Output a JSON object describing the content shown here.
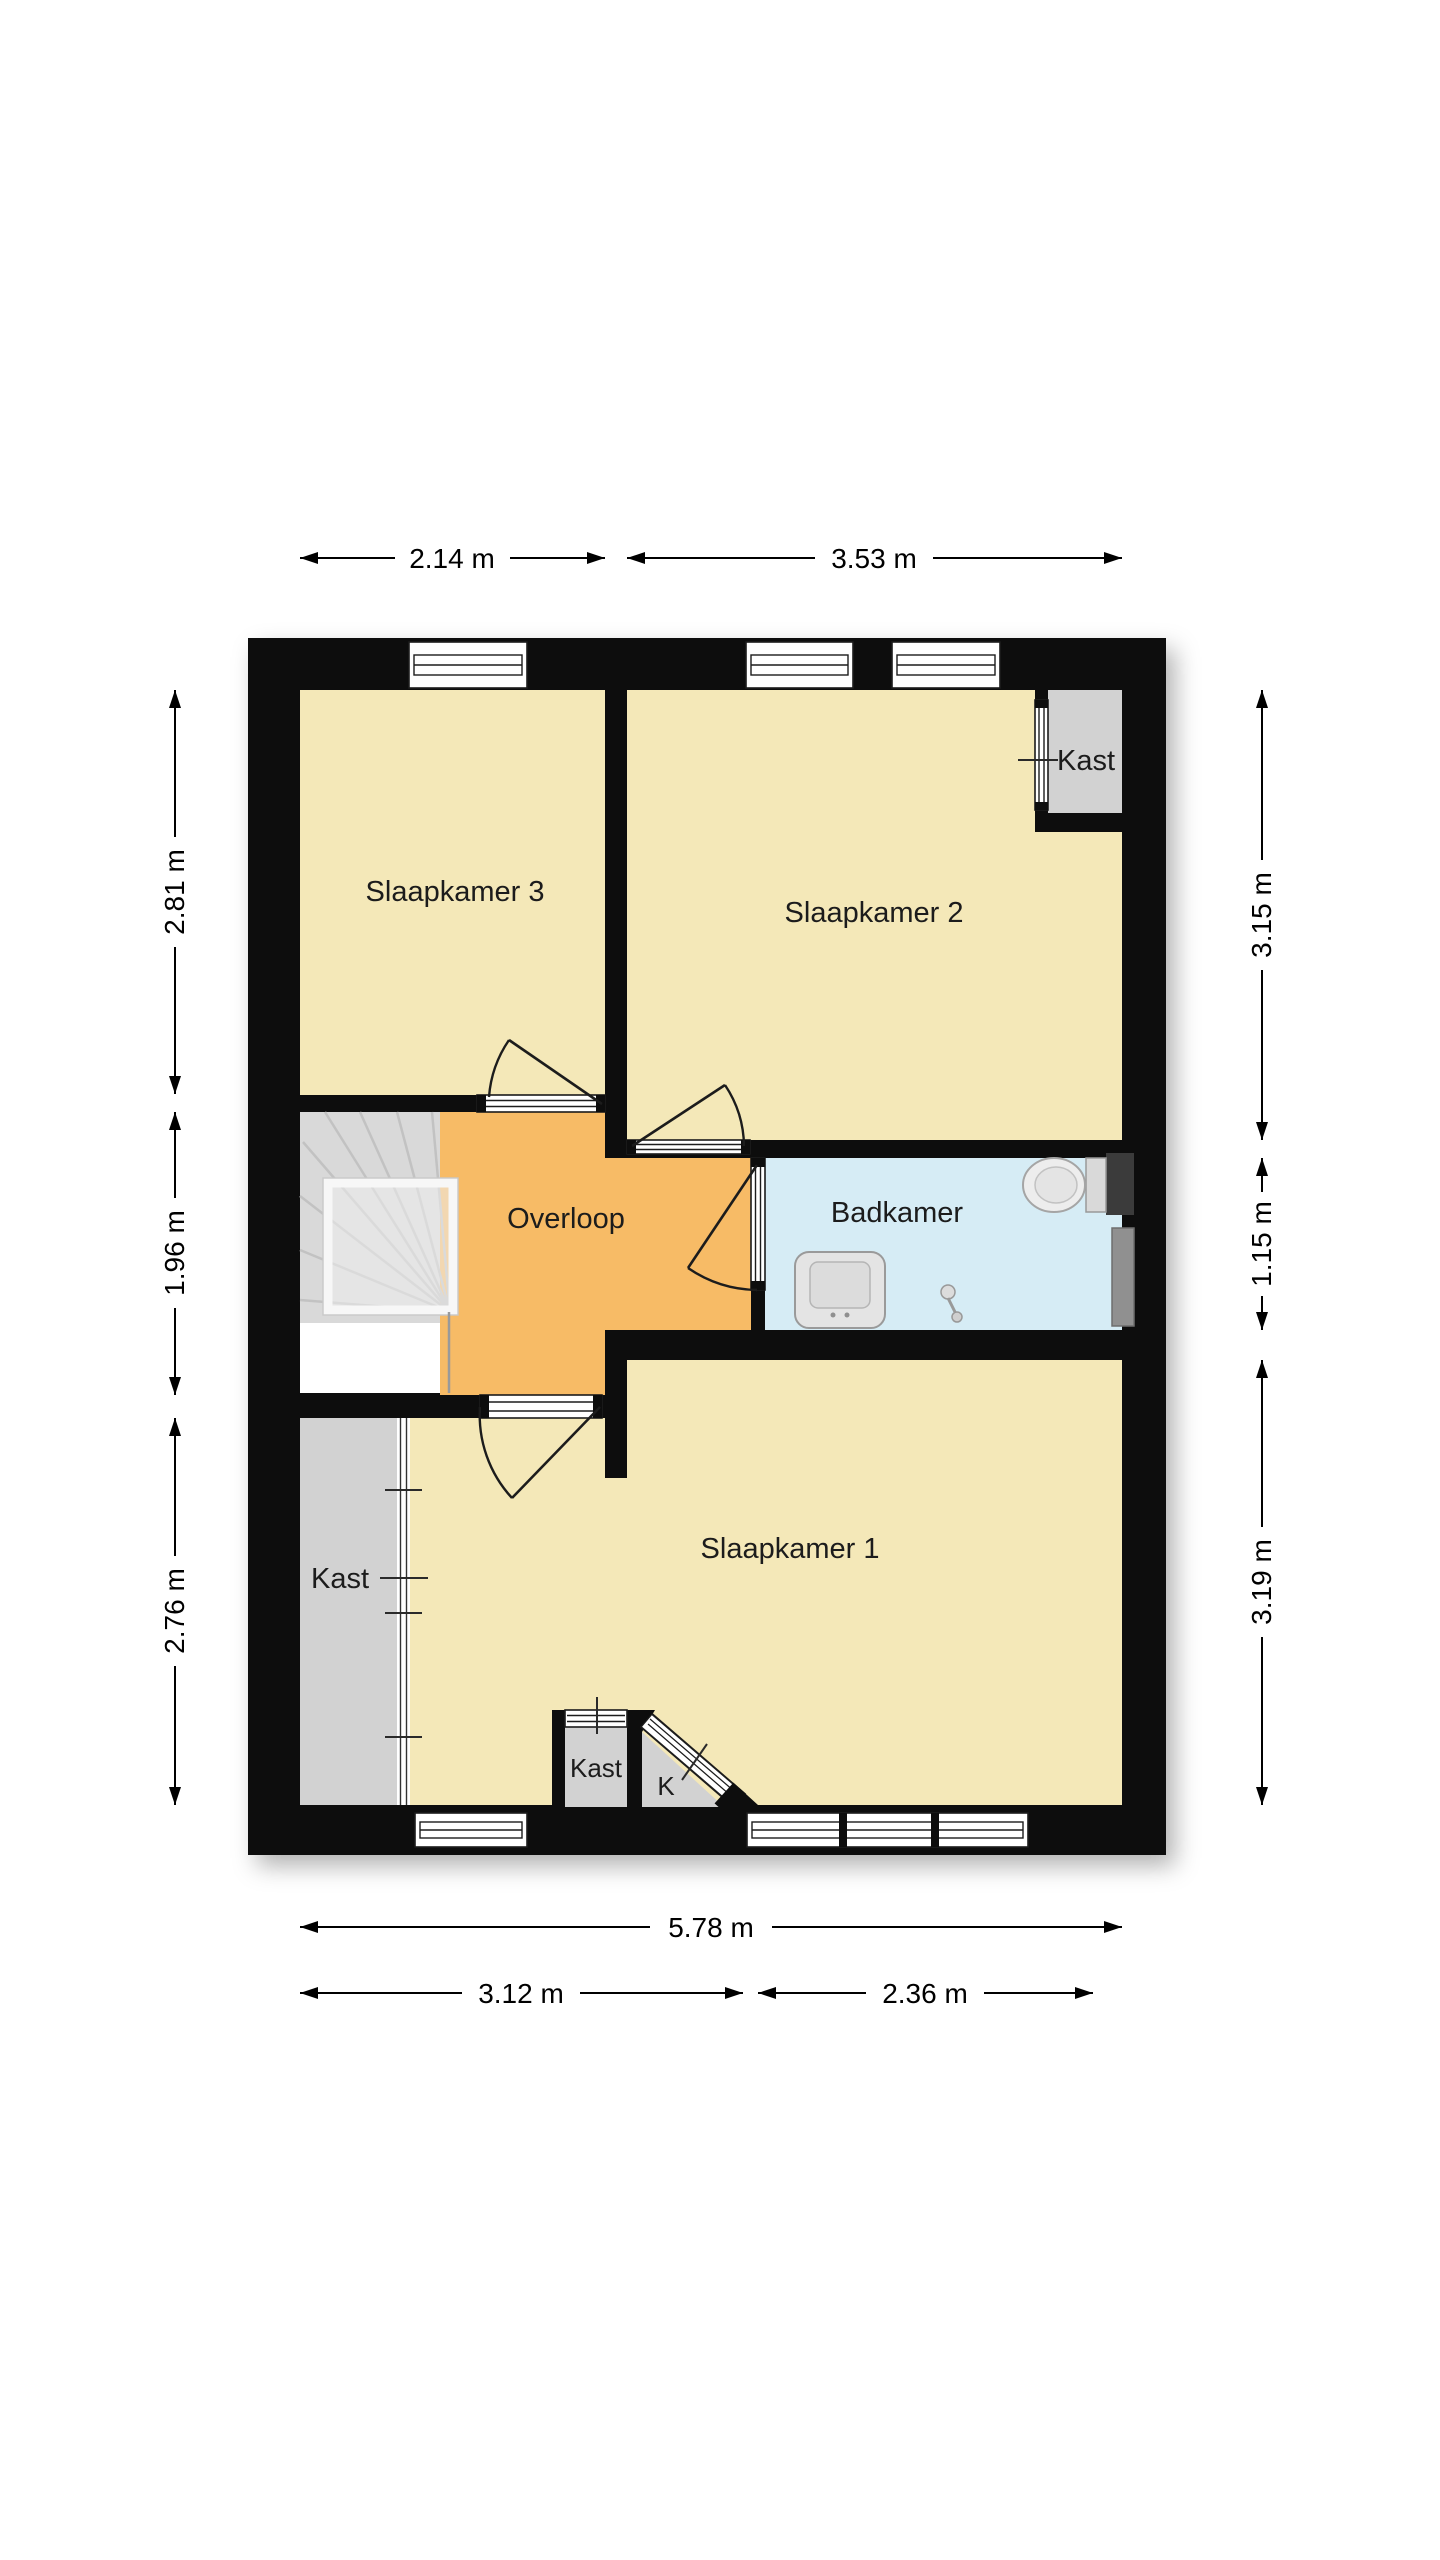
{
  "floorplan": {
    "rooms": {
      "slaapkamer3": "Slaapkamer 3",
      "slaapkamer2": "Slaapkamer 2",
      "slaapkamer1": "Slaapkamer 1",
      "overloop": "Overloop",
      "badkamer": "Badkamer",
      "kast_top_right": "Kast",
      "kast_left": "Kast",
      "kast_small": "Kast",
      "kast_k": "K"
    },
    "dimensions": {
      "top": [
        "2.14 m",
        "3.53 m"
      ],
      "left": [
        "2.81 m",
        "1.96 m",
        "2.76 m"
      ],
      "right": [
        "3.15 m",
        "1.15 m",
        "3.19 m"
      ],
      "bottom_total": "5.78 m",
      "bottom_left": "3.12 m",
      "bottom_right": "2.36 m"
    },
    "colors": {
      "wall": "#0c0c0c",
      "room": "#f4e8b8",
      "hall": "#f7bb66",
      "bath": "#d6ecf5",
      "closet": "#d2d2d2",
      "stairs": "#d9d9d9"
    }
  }
}
